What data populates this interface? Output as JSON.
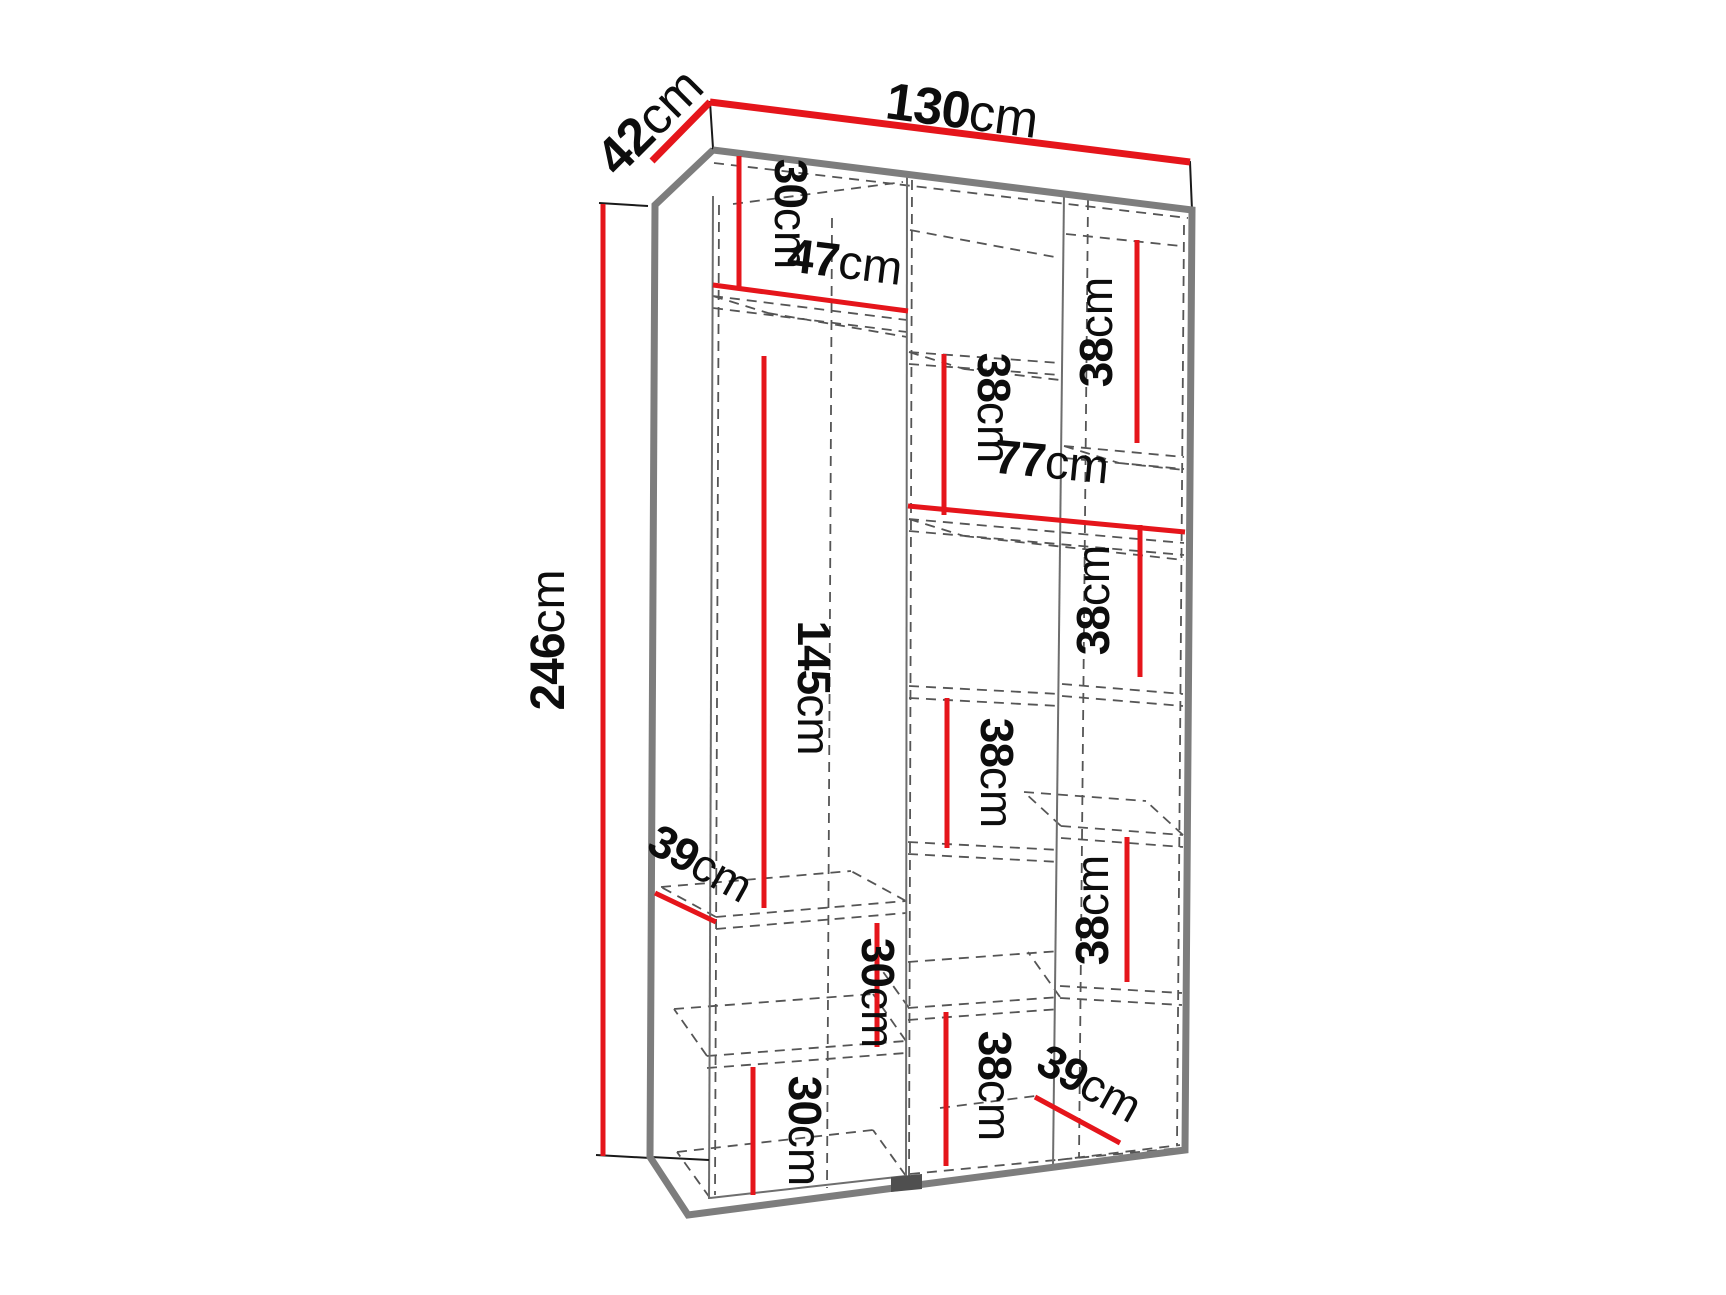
{
  "diagram": {
    "type": "furniture-dimension-diagram",
    "subject": "two-door wardrobe with staggered interior shelves",
    "unit": "cm",
    "colors": {
      "dimension_line": "#e5151b",
      "edge_gray": "#7d7d7d",
      "hidden_line": "#555555",
      "label_text": "#0d0d0d",
      "background": "#ffffff"
    },
    "overall": {
      "width_cm": 130,
      "depth_cm": 42,
      "height_cm": 246
    },
    "labels": {
      "width": {
        "value": "130",
        "unit": "cm"
      },
      "depth": {
        "value": "42",
        "unit": "cm"
      },
      "height": {
        "value": "246",
        "unit": "cm"
      },
      "top_left_gap": {
        "value": "30",
        "unit": "cm"
      },
      "left_col_width": {
        "value": "47",
        "unit": "cm"
      },
      "left_col_height": {
        "value": "145",
        "unit": "cm"
      },
      "left_shelf_depth": {
        "value": "39",
        "unit": "cm"
      },
      "left_mid_gap": {
        "value": "30",
        "unit": "cm"
      },
      "left_bottom_gap": {
        "value": "30",
        "unit": "cm"
      },
      "right_sec_width": {
        "value": "77",
        "unit": "cm"
      },
      "mid_col_gap_1": {
        "value": "38",
        "unit": "cm"
      },
      "mid_col_gap_2": {
        "value": "38",
        "unit": "cm"
      },
      "mid_col_gap_3": {
        "value": "38",
        "unit": "cm"
      },
      "right_col_gap_1": {
        "value": "38",
        "unit": "cm"
      },
      "right_col_gap_2": {
        "value": "38",
        "unit": "cm"
      },
      "right_col_gap_3": {
        "value": "38",
        "unit": "cm"
      },
      "right_shelf_depth": {
        "value": "39",
        "unit": "cm"
      }
    }
  }
}
